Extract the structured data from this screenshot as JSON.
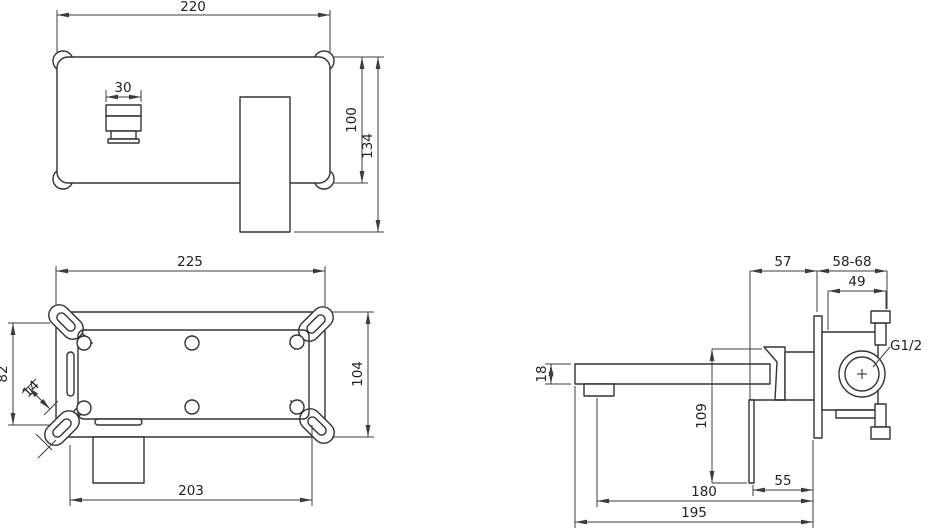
{
  "drawing": {
    "background": "#ffffff",
    "line_color": "#333333",
    "views": {
      "front": {
        "dims": {
          "plate_width": "220",
          "spout_width": "30",
          "plate_height": "100",
          "overall_height": "134"
        }
      },
      "bracket": {
        "dims": {
          "width": "225",
          "height": "104",
          "slot_spacing": "82",
          "slot_width": "14",
          "bottom_width": "203"
        }
      },
      "side": {
        "dims": {
          "front_depth": "57",
          "wall_depth_range": "58-68",
          "valve_width": "49",
          "thread_size": "G1/2",
          "spout_height": "18",
          "handle_length": "109",
          "handle_clearance": "55",
          "aerator_reach": "180",
          "spout_reach": "195"
        }
      }
    }
  }
}
